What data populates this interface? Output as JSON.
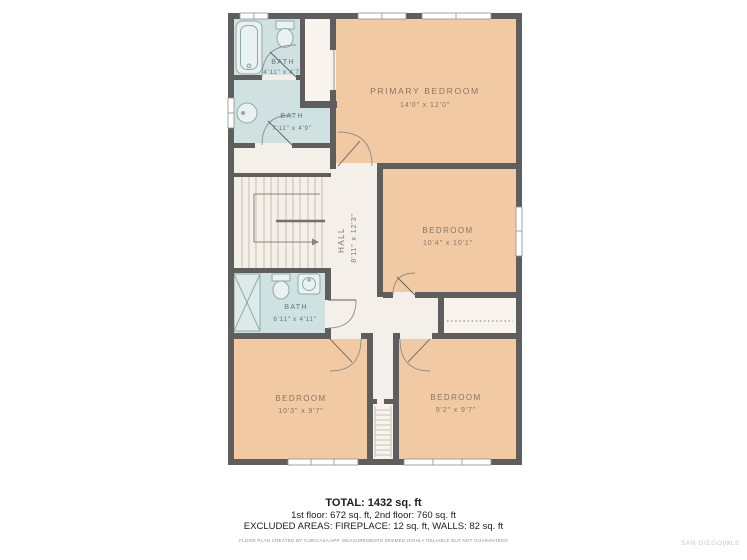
{
  "plan": {
    "rooms": [
      {
        "id": "bath-top",
        "name": "BATH",
        "dims": "4'11\" x 4'7\""
      },
      {
        "id": "bath-mid",
        "name": "BATH",
        "dims": "7'11\" x 4'9\""
      },
      {
        "id": "bath-lower",
        "name": "BATH",
        "dims": "6'11\" x 4'11\""
      },
      {
        "id": "hall",
        "name": "HALL",
        "dims": "8'11\" x 12'3\""
      },
      {
        "id": "primary-bedroom",
        "name": "PRIMARY BEDROOM",
        "dims": "14'0\" x 12'0\""
      },
      {
        "id": "bedroom-right",
        "name": "BEDROOM",
        "dims": "10'4\" x 10'1\""
      },
      {
        "id": "bedroom-bottom-left",
        "name": "BEDROOM",
        "dims": "10'3\" x 9'7\""
      },
      {
        "id": "bedroom-bottom-right",
        "name": "BEDROOM",
        "dims": "9'2\" x 9'7\""
      }
    ],
    "colors": {
      "wall": "#5e5e5e",
      "bedroom_fill": "#f1caa3",
      "bath_fill": "#cfe2e1",
      "floor_fill": "#f4efe8",
      "closet_fill": "#f8f4ed",
      "bedroom_label": "#877565",
      "bath_label": "#657677"
    }
  },
  "summary": {
    "total": "TOTAL: 1432 sq. ft",
    "floors": "1st floor: 672 sq. ft, 2nd floor: 760 sq. ft",
    "excluded": "EXCLUDED AREAS: FIREPLACE: 12 sq. ft, WALLS: 82 sq. ft",
    "disclaimer": "FLOOR PLAN CREATED BY CUBICASA APP. MEASUREMENTS DEEMED HIGHLY RELIABLE BUT NOT GUARANTEED",
    "watermark": "SAN DIEGO|MLS"
  }
}
